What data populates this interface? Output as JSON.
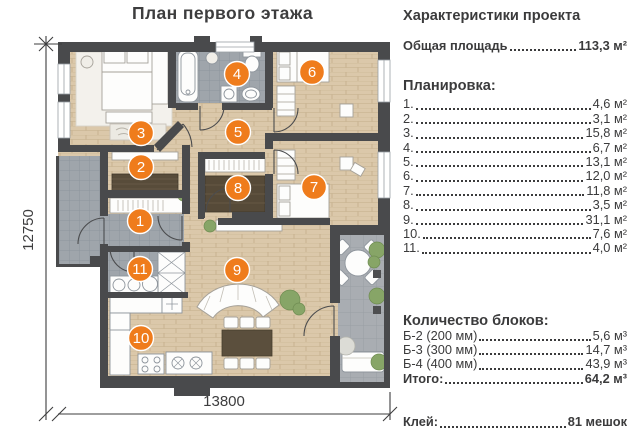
{
  "title": "План первого этажа",
  "plan": {
    "dim_height": "12750",
    "dim_width": "13800",
    "room_numbers": [
      "1",
      "2",
      "3",
      "4",
      "5",
      "6",
      "7",
      "8",
      "9",
      "10",
      "11"
    ]
  },
  "panel": {
    "heading": "Характеристики проекта",
    "total_area": {
      "label": "Общая площадь",
      "value": "113,3 м²"
    },
    "layout_heading": "Планировка:",
    "layout_items": [
      {
        "num": "1.",
        "value": "4,6 м²"
      },
      {
        "num": "2.",
        "value": "3,1 м²"
      },
      {
        "num": "3.",
        "value": "15,8 м²"
      },
      {
        "num": "4.",
        "value": "6,7 м²"
      },
      {
        "num": "5.",
        "value": "13,1 м²"
      },
      {
        "num": "6.",
        "value": "12,0 м²"
      },
      {
        "num": "7.",
        "value": "11,8 м²"
      },
      {
        "num": "8.",
        "value": "3,5 м²"
      },
      {
        "num": "9.",
        "value": "31,1 м²"
      },
      {
        "num": "10.",
        "value": "7,6 м²"
      },
      {
        "num": "11.",
        "value": "4,0 м²"
      }
    ],
    "blocks_heading": "Количество блоков:",
    "blocks": [
      {
        "label": "Б-2 (200 мм)",
        "value": "5,6 м³"
      },
      {
        "label": "Б-3 (300 мм)",
        "value": "14,7 м³"
      },
      {
        "label": "Б-4 (400 мм)",
        "value": "43,9 м³"
      }
    ],
    "total_blocks": {
      "label": "Итого:",
      "value": "64,2 м³"
    },
    "glue": {
      "label": "Клей:",
      "value": "81 мешок"
    }
  },
  "colors": {
    "accent_orange": "#ef7c1c",
    "wall": "#494a4c",
    "wood_floor": "#dbc8aa",
    "tile_floor": "#9fa5ab",
    "terrace_tile": "#a9adb2",
    "plant_green": "#87a567",
    "text": "#3b3b3c"
  }
}
